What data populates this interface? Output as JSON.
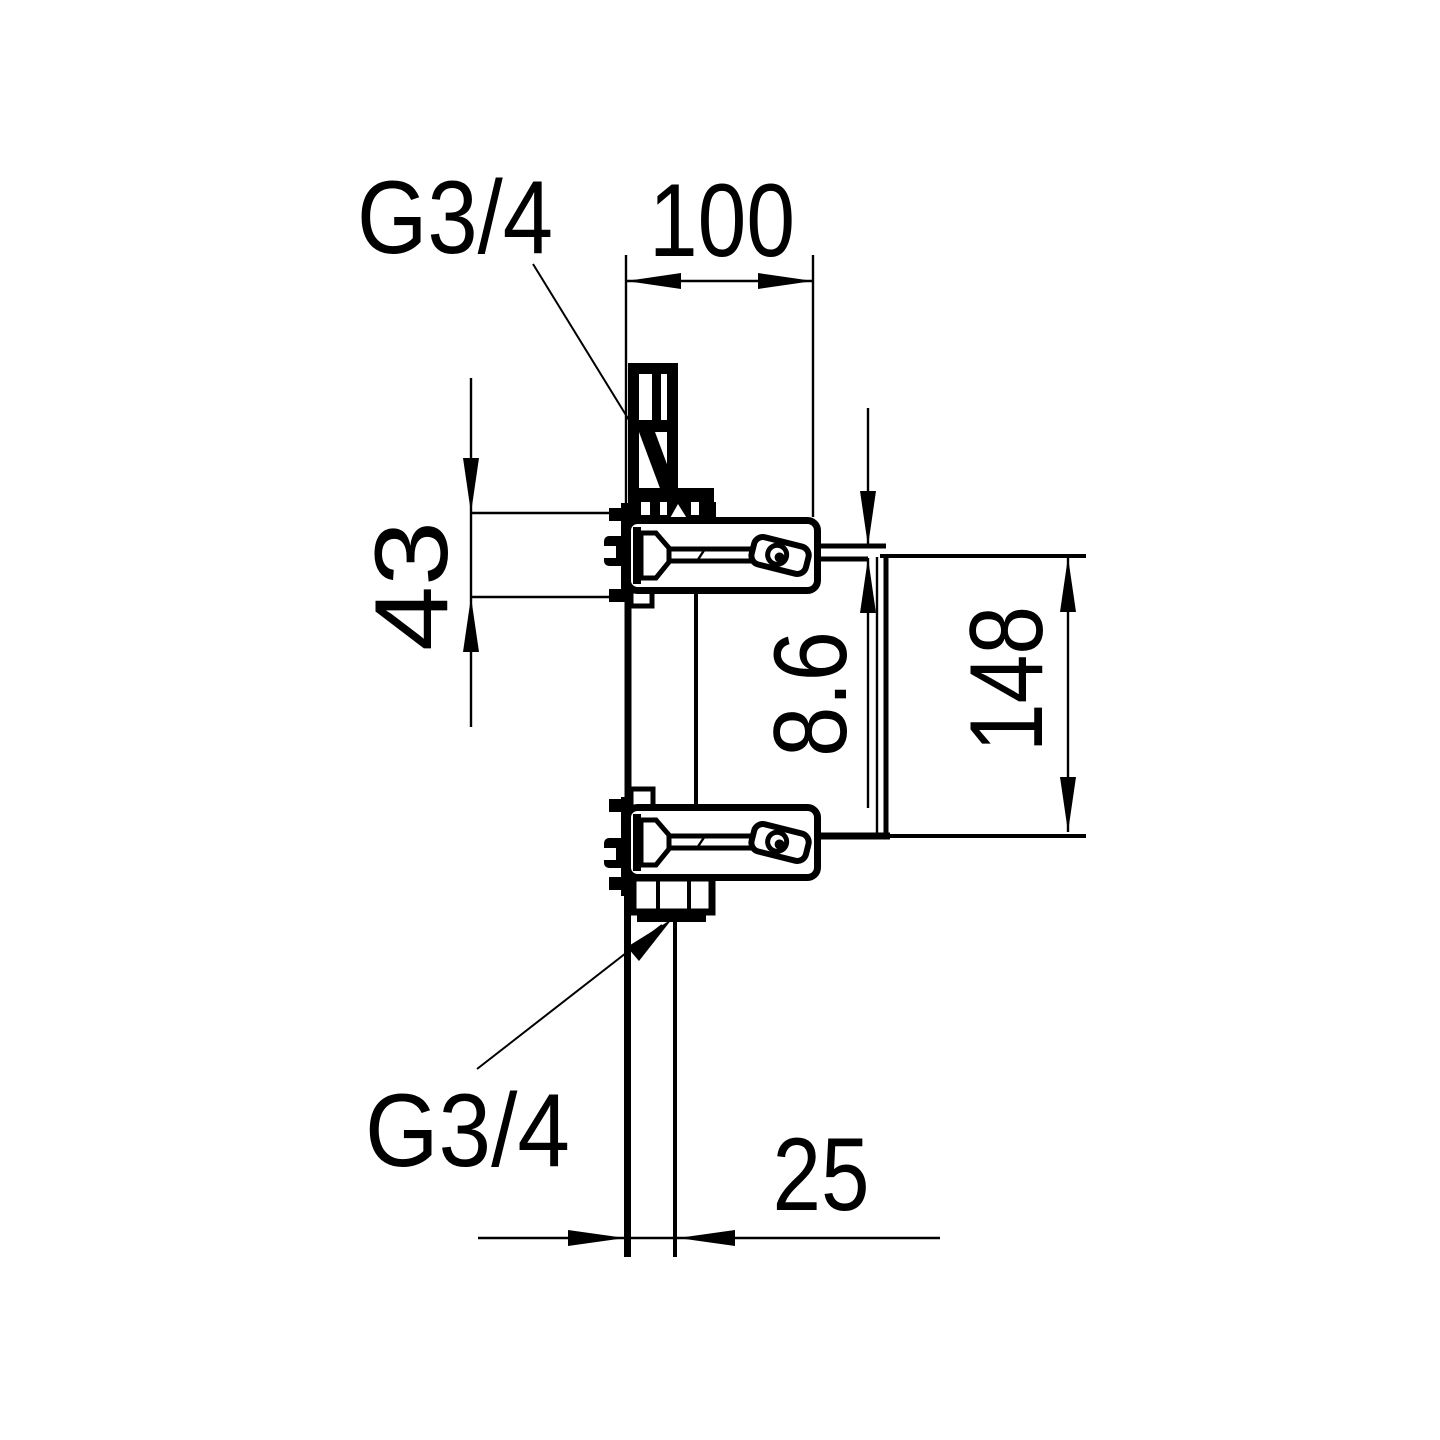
{
  "drawing": {
    "type": "technical-installation-drawing",
    "subject": "concealed two-port valve body, side view with mounting bracket and supply pipe",
    "colors": {
      "ink": "#000000",
      "paper": "#ffffff"
    },
    "labels": {
      "thread_top": "G3/4",
      "thread_bottom": "G3/4"
    },
    "dimensions": {
      "body_depth": "100",
      "bracket_hole_spacing": "43",
      "wall_offset": "8.6",
      "port_spacing": "148",
      "pipe_offset": "25"
    }
  }
}
